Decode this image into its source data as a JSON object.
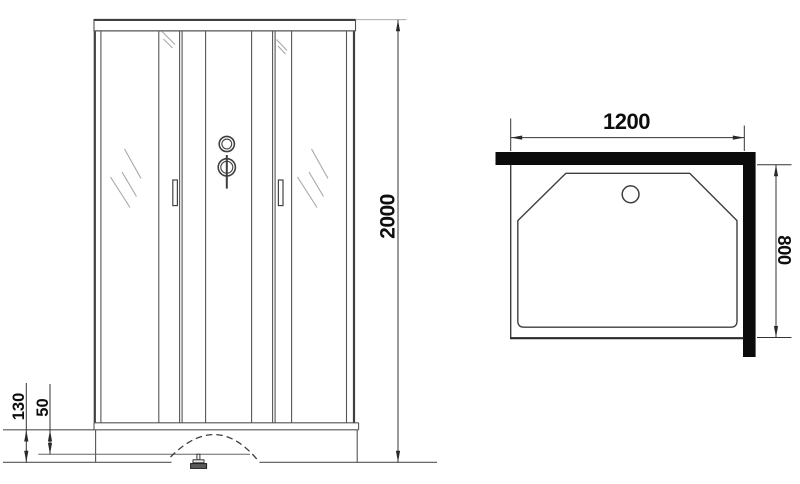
{
  "title": "Shower cabin dimensional drawing",
  "views": {
    "front": {
      "label": "front view",
      "dims": {
        "height": "2000",
        "base_height": "130",
        "base_inner": "50"
      }
    },
    "top": {
      "label": "top view",
      "dims": {
        "width": "1200",
        "depth": "800"
      }
    }
  },
  "colors": {
    "background": "#ffffff",
    "line": "#555555",
    "outline": "#3f3f3f",
    "dimension": "#333333",
    "wall_profile": "#0b0b0b",
    "text": "#0d0d0d",
    "hatch": "#a8a8a8"
  }
}
